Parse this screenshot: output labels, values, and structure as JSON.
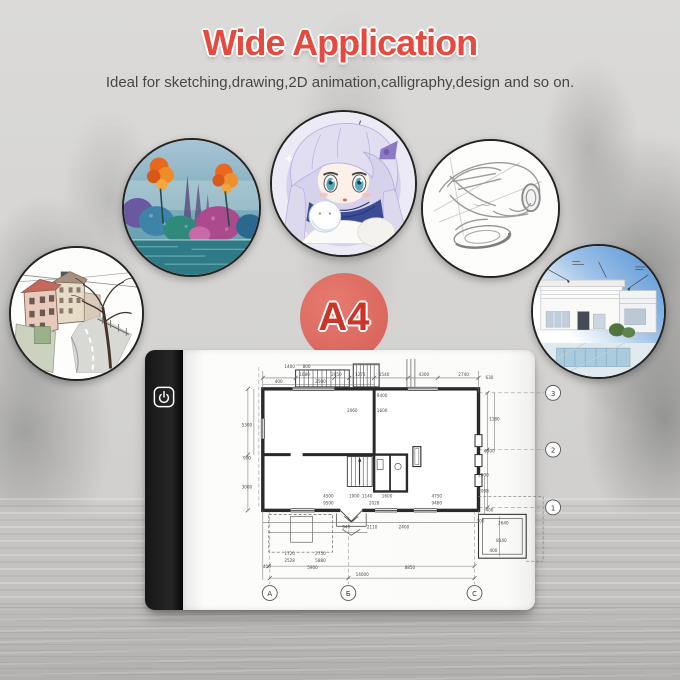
{
  "header": {
    "title": "Wide Application",
    "subtitle": "Ideal for sketching,drawing,2D animation,calligraphy,design and so on."
  },
  "badge": {
    "label": "A4"
  },
  "colors": {
    "title_red": "#e6493e",
    "badge_fill": "#dd5f55",
    "badge_text": "#c9352b",
    "pad_strip_black": "#1d1d1d",
    "pad_surface_white": "#fbfbfa",
    "blueprint_line": "#2a2a2a",
    "background_gray": "#d5d4d2"
  },
  "gallery": {
    "items": [
      {
        "name": "street-sketch"
      },
      {
        "name": "landscape-painting"
      },
      {
        "name": "anime-illustration"
      },
      {
        "name": "car-concept-sketch"
      },
      {
        "name": "modern-house-render"
      }
    ]
  },
  "light_pad": {
    "power_icon": "power-icon",
    "blueprint": {
      "row_markers": [
        "3",
        "2",
        "1"
      ],
      "col_markers": [
        "А",
        "Б",
        "C"
      ],
      "dim_labels": [
        {
          "t": "1680",
          "x": 72,
          "y": 19
        },
        {
          "t": "2050",
          "x": 104,
          "y": 19
        },
        {
          "t": "1273",
          "x": 128,
          "y": 19
        },
        {
          "t": "1540",
          "x": 152,
          "y": 19
        },
        {
          "t": "4300",
          "x": 192,
          "y": 19
        },
        {
          "t": "2740",
          "x": 232,
          "y": 19
        },
        {
          "t": "2500",
          "x": 88,
          "y": 26
        },
        {
          "t": "800",
          "x": 74,
          "y": 11
        },
        {
          "t": "1400",
          "x": 57,
          "y": 11
        },
        {
          "t": "400",
          "x": 46,
          "y": 26
        },
        {
          "t": "5300",
          "x": 14,
          "y": 70
        },
        {
          "t": "900",
          "x": 14,
          "y": 103
        },
        {
          "t": "3000",
          "x": 14,
          "y": 132
        },
        {
          "t": "2060",
          "x": 120,
          "y": 55
        },
        {
          "t": "1600",
          "x": 150,
          "y": 55
        },
        {
          "t": "9400",
          "x": 150,
          "y": 40
        },
        {
          "t": "4500",
          "x": 96,
          "y": 141
        },
        {
          "t": "1000",
          "x": 122,
          "y": 141
        },
        {
          "t": "1140",
          "x": 135,
          "y": 141
        },
        {
          "t": "1600",
          "x": 155,
          "y": 141
        },
        {
          "t": "4750",
          "x": 205,
          "y": 141
        },
        {
          "t": "9500",
          "x": 96,
          "y": 148
        },
        {
          "t": "2028",
          "x": 142,
          "y": 148
        },
        {
          "t": "9480",
          "x": 205,
          "y": 148
        },
        {
          "t": "940",
          "x": 114,
          "y": 172
        },
        {
          "t": "2110",
          "x": 140,
          "y": 172
        },
        {
          "t": "2400",
          "x": 172,
          "y": 172
        },
        {
          "t": "2008",
          "x": 252,
          "y": 136
        },
        {
          "t": "300",
          "x": 249,
          "y": 166
        },
        {
          "t": "2640",
          "x": 272,
          "y": 168
        },
        {
          "t": "8140",
          "x": 270,
          "y": 186
        },
        {
          "t": "400",
          "x": 262,
          "y": 196
        },
        {
          "t": "1720",
          "x": 57,
          "y": 199
        },
        {
          "t": "2750",
          "x": 88,
          "y": 199
        },
        {
          "t": "2528",
          "x": 57,
          "y": 206
        },
        {
          "t": "5880",
          "x": 88,
          "y": 206
        },
        {
          "t": "400",
          "x": 34,
          "y": 212
        },
        {
          "t": "5900",
          "x": 80,
          "y": 213
        },
        {
          "t": "8850",
          "x": 178,
          "y": 213
        },
        {
          "t": "14000",
          "x": 130,
          "y": 220
        },
        {
          "t": "630",
          "x": 258,
          "y": 22
        },
        {
          "t": "1180",
          "x": 263,
          "y": 64
        },
        {
          "t": "6300",
          "x": 258,
          "y": 96
        },
        {
          "t": "2000",
          "x": 252,
          "y": 120
        },
        {
          "t": "400",
          "x": 258,
          "y": 155
        }
      ]
    }
  }
}
